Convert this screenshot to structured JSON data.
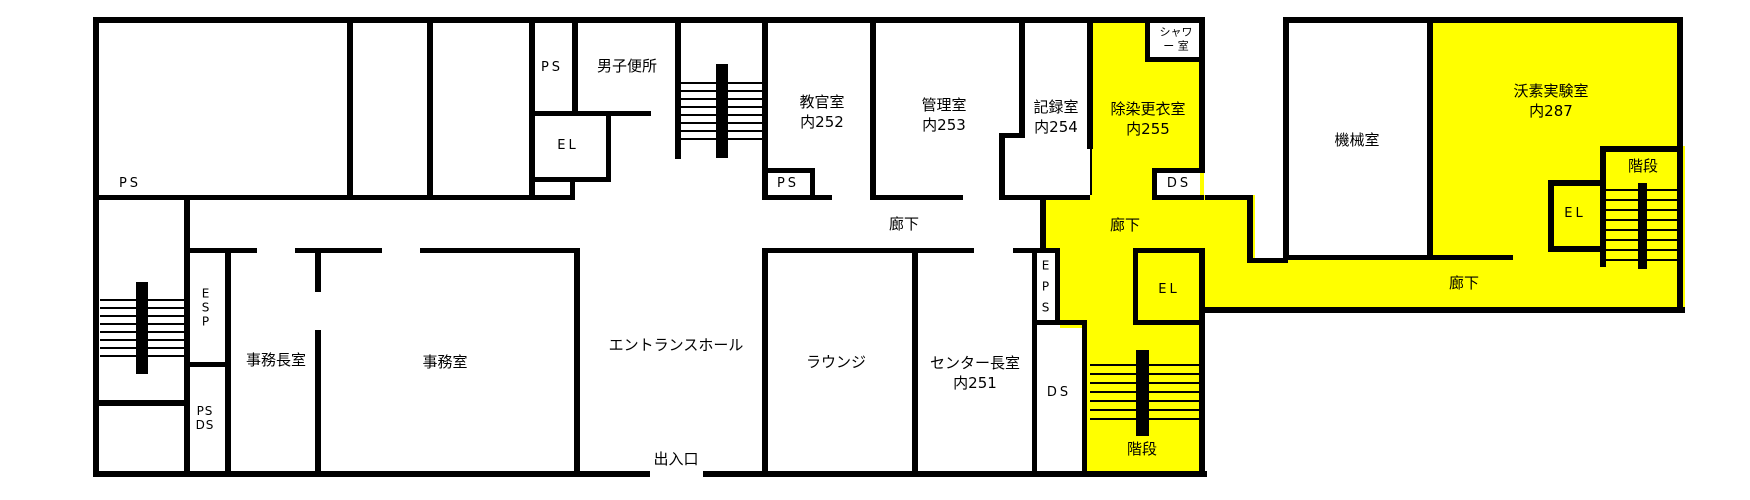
{
  "title": "建物平面図",
  "colors": {
    "highlight": "#ffff00",
    "wall": "#000000",
    "background": "#ffffff"
  },
  "labels": {
    "ps_box_left": "PS",
    "ps_upper": "PS",
    "mens_toilet": "男子便所",
    "el_upper": "EL",
    "instructor_room": "教官室\n内252",
    "admin_room": "管理室\n内253",
    "records_room": "記録室\n内254",
    "decon_room": "除染更衣室\n内255",
    "shower_room": "シャワ\nー 室",
    "ps_mid": "PS",
    "ds_top": "DS",
    "corridor_west": "廊下",
    "corridor_yellow": "廊下",
    "corridor_east": "廊下",
    "machine_room": "機械室",
    "iodine_lab": "沃素実験室\n内287",
    "stairs_east": "階段",
    "el_east": "EL",
    "esp_shaft": "E\nS\nP",
    "ps_ds_shaft": "PS\nDS",
    "office_chief_room": "事務長室",
    "office_room": "事務室",
    "entrance_hall": "エントランスホール",
    "entrance_exit": "出入口",
    "lounge": "ラウンジ",
    "center_director_room": "センター長室\n内251",
    "eps_shaft": "E\nP\nS",
    "ds_bottom": "DS",
    "el_yellow": "EL",
    "stairs_south": "階段"
  }
}
